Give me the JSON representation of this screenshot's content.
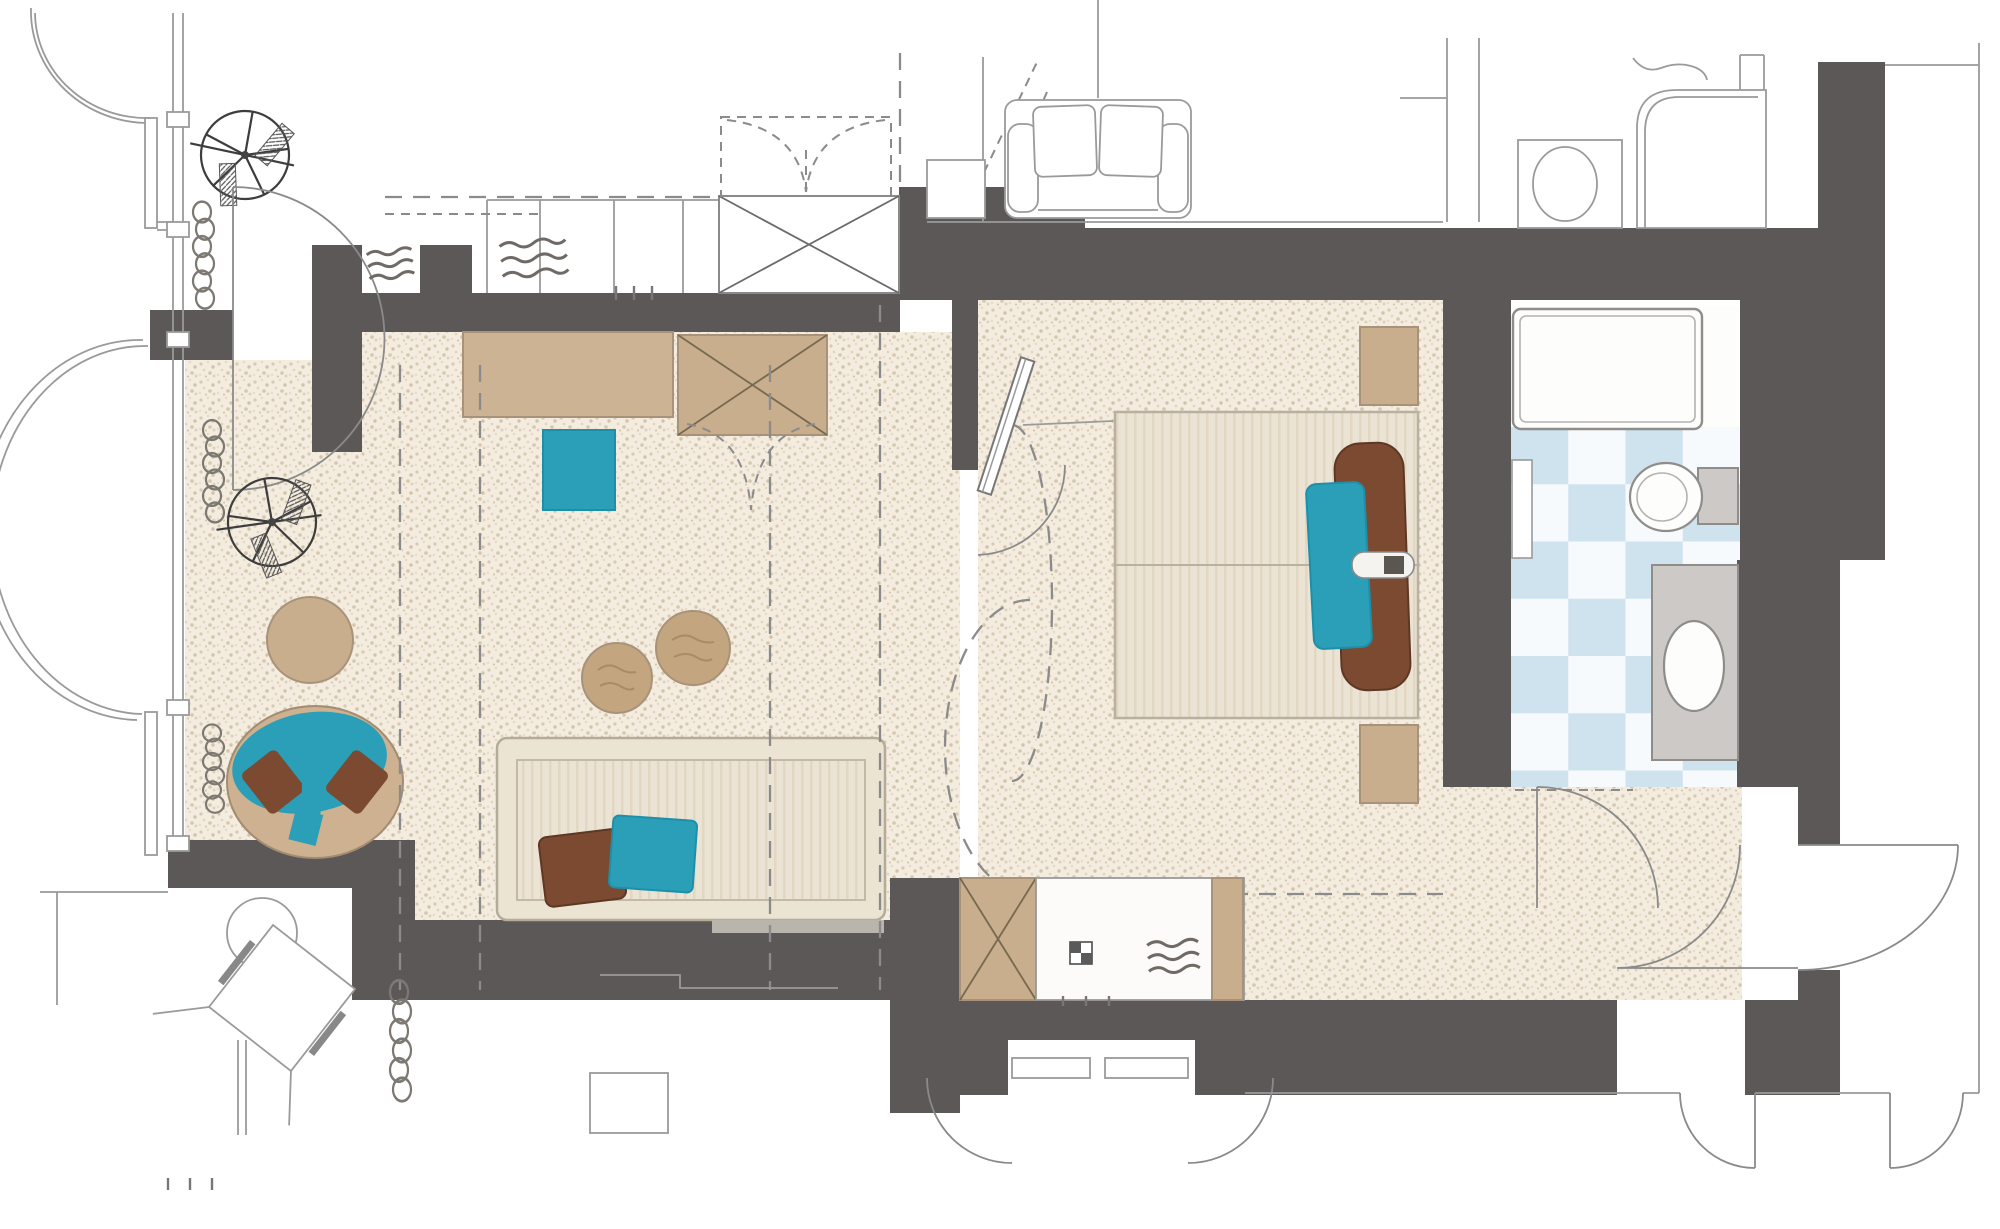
{
  "meta": {
    "title": "Hotel suite floor plan",
    "type": "architectural-floor-plan",
    "orientation": "top-down"
  },
  "palette": {
    "wall": "#5d5858",
    "floor_base": "#f3ecdf",
    "floor_dot": "#d7cab2",
    "tan": "#c9ae8d",
    "tan_light": "#cbb394",
    "tan_edge": "#a8937a",
    "teal": "#2b9fb8",
    "teal_edge": "#1e8fa9",
    "brown": "#7b4a31",
    "brown_edge": "#5e3825",
    "fabric": "#ebe3d3",
    "fabric_stripe": "#e1d7c3",
    "wood": "#c3a57f",
    "tile_blue": "#cfe3ee",
    "tile_white": "#f7fafc",
    "fixture_gray": "#cdc9c6",
    "line": "#8f8c8a",
    "outline": "#9a9a9a"
  },
  "rooms": [
    {
      "name": "veranda",
      "floor": "white",
      "features": [
        "curved-bay-window",
        "ceiling-fan-symbol",
        "radiator-coil",
        "double-swing-door"
      ]
    },
    {
      "name": "sitting-room",
      "floor": "stipple",
      "furniture": [
        "round-side-table",
        "tub-chair-with-teal-throw",
        "ceiling-fan-symbol",
        "radiator-coils"
      ]
    },
    {
      "name": "living-room",
      "floor": "stipple",
      "furniture": [
        "sideboard",
        "crossed-wardrobe",
        "teal-stool",
        "two-round-coffee-tables",
        "sofa-with-pillows",
        "bifold-closet-doors"
      ]
    },
    {
      "name": "corridor-kitchenette",
      "floor": "stipple",
      "furniture": [
        "crossed-minibar-cabinet",
        "counter-with-sink",
        "vent-grille",
        "double-swing-door-arcs"
      ]
    },
    {
      "name": "bedroom",
      "floor": "stipple",
      "furniture": [
        "double-bed",
        "two-nightstands",
        "long-brown-pillow",
        "teal-pillow",
        "wall-tv",
        "door-swing-arcs"
      ]
    },
    {
      "name": "bathroom",
      "floor": "blue-white-checker-tile",
      "furniture": [
        "bathtub",
        "toilet",
        "vanity-with-basin",
        "door-swing"
      ]
    },
    {
      "name": "entry-hall",
      "floor": "stipple",
      "furniture": [
        "entry-door-swing",
        "closet-arc"
      ]
    },
    {
      "name": "neighbor-context",
      "floor": "white",
      "furniture": [
        "outline-loveseat",
        "outline-toilet",
        "outline-shower",
        "outline-table-and-chair",
        "corridor-door-swings",
        "overhead-dashed-cabinets",
        "crossed-shaft"
      ]
    }
  ],
  "symbols": [
    "ceiling-fan",
    "radiator-coil",
    "vent-grille",
    "crossed-box-shaft",
    "door-swing-arc",
    "dashed-ceiling-line"
  ]
}
